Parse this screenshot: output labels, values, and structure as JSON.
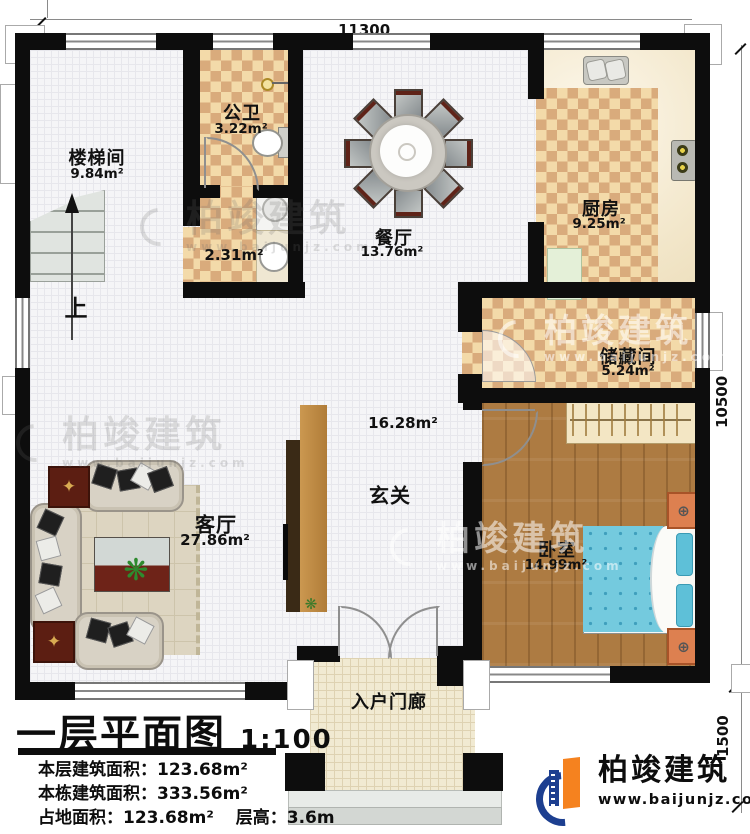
{
  "doc": {
    "title": "一层平面图",
    "scale": "1:100"
  },
  "dims": {
    "top": "11300",
    "right": "10500",
    "right_lower": "1500"
  },
  "rooms": {
    "stairwell": {
      "name": "楼梯间",
      "area": "9.84m²"
    },
    "bathroom": {
      "name": "公卫",
      "area": "3.22m²"
    },
    "laundry": {
      "area": "2.31m²"
    },
    "dining": {
      "name": "餐厅",
      "area": "13.76m²"
    },
    "kitchen": {
      "name": "厨房",
      "area": "9.25m²"
    },
    "storage": {
      "name": "储藏间",
      "area": "5.24m²"
    },
    "foyer": {
      "name": "玄关",
      "area": "16.28m²"
    },
    "living": {
      "name": "客厅",
      "area": "27.86m²"
    },
    "bedroom": {
      "name": "卧室",
      "area": "14.99m²"
    },
    "porch": {
      "name": "入户门廊"
    }
  },
  "annotations": {
    "stairs_up": "上"
  },
  "stats": [
    {
      "label": "本层建筑面积：",
      "value": "123.68m²"
    },
    {
      "label": "本栋建筑面积：",
      "value": "333.56m²"
    },
    {
      "label": "占地面积：",
      "value": "123.68m²"
    },
    {
      "label": "层高：",
      "value": "3.6m"
    }
  ],
  "brand": {
    "name": "柏竣建筑",
    "website": "www.baijunjz.com"
  },
  "watermark": {
    "name": "柏竣建筑",
    "website": "www.baijunjz.com"
  },
  "colors": {
    "checker_light": "#f3daa9",
    "checker_dark": "#d9ab7c",
    "wood": "#ad7b42",
    "bed": "#74cade",
    "tv_wall": "#c08a44",
    "logo_blue": "#1d3f90",
    "logo_orange": "#f5821f"
  }
}
